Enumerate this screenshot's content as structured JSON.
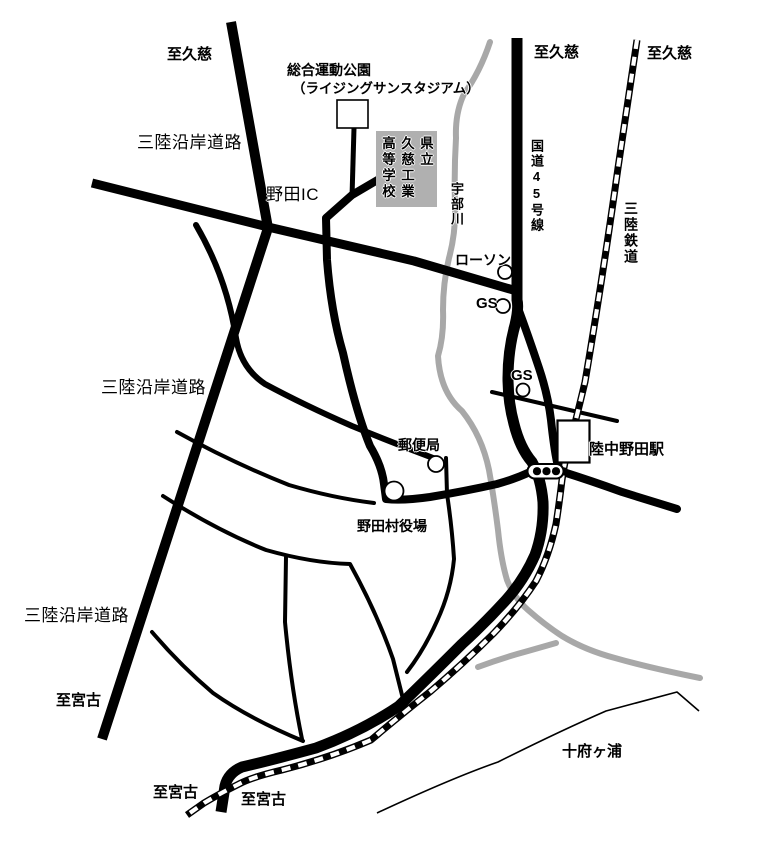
{
  "map": {
    "colors": {
      "road": "#000000",
      "river": "#a8a8a8",
      "school_box_bg": "#b0b0b0",
      "background": "#ffffff"
    },
    "destinations": {
      "to_kuji_expressway": "至久慈",
      "to_kuji_route45": "至久慈",
      "to_kuji_railway": "至久慈",
      "to_miyako_expressway": "至宮古",
      "to_miyako_railway": "至宮古",
      "to_miyako_route45": "至宮古"
    },
    "roads": {
      "sanriku_coastal_road_1": "三陸沿岸道路",
      "sanriku_coastal_road_2": "三陸沿岸道路",
      "sanriku_coastal_road_3": "三陸沿岸道路",
      "noda_ic": "野田IC",
      "route45": "国道45号線"
    },
    "railway": {
      "sanriku_railway": "三陸鉄道",
      "rikuchu_noda_station": "陸中野田駅"
    },
    "river": {
      "ubegawa": "宇部川"
    },
    "pois": {
      "sports_park_line1": "総合運動公園",
      "sports_park_line2": "（ライジングサンスタジアム）",
      "school": {
        "col1": "県立",
        "col2": "久慈工業",
        "col3": "高等学校"
      },
      "lawson": "ローソン",
      "gas_station_1": "GS",
      "gas_station_2": "GS",
      "post_office": "郵便局",
      "village_office": "野田村役場",
      "tofugaura": "十府ヶ浦"
    }
  }
}
